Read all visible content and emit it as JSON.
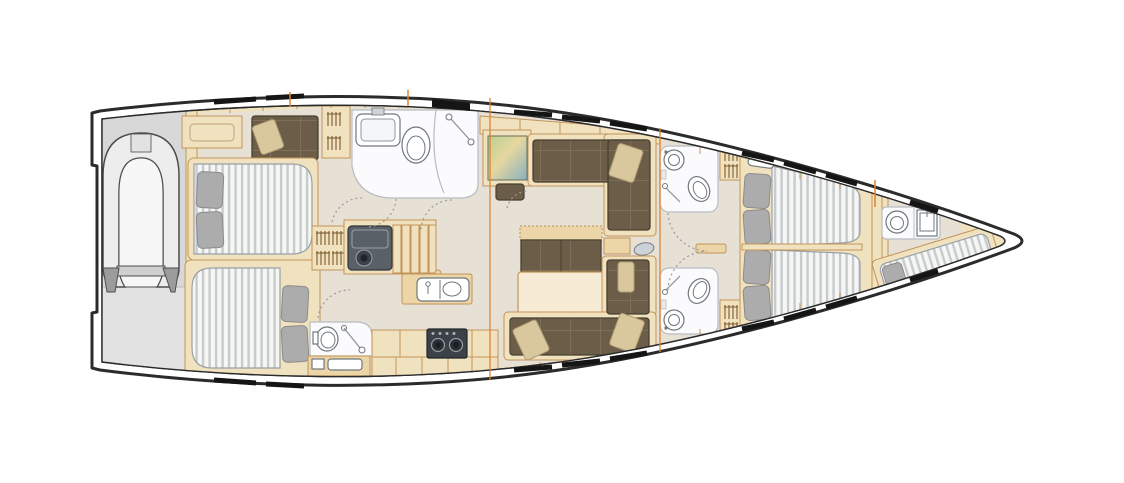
{
  "meta": {
    "label": "sailing-yacht-interior-deck-plan",
    "orientation": "bow-right",
    "visible_text": ""
  },
  "palette": {
    "hull_outline": "#2b2b2b",
    "deck_tan": "#f1e2bf",
    "deck_tan_dark": "#ecd5a6",
    "wood_line": "#c2945a",
    "floor_gray": "#e7e1d5",
    "garage_gray": "#d8d8d8",
    "garage_gray_light": "#e2e2e2",
    "white_room": "#fbfbfd",
    "room_line": "#b7bcc2",
    "fixture_line": "#6f777e",
    "mattress_white": "#f6f6f3",
    "mattress_stripe": "#c6cbd0",
    "mattress_line": "#9aa0a6",
    "pillow_gray": "#acacac",
    "pillow_gray_line": "#8b8b8b",
    "sofa_brown": "#6b5d48",
    "sofa_grid": "#7d6f58",
    "sofa_line": "#46402f",
    "pillow_tan": "#d9c79d",
    "pillow_tan_line": "#b19c72",
    "hatch_black": "#151515",
    "bulkhead_orange": "#e0812f",
    "door_dash": "#9a9a9a",
    "dinghy_gray": "#ededed",
    "dinghy_dark": "#9c9c9c",
    "dinghy_line": "#4d4d4d",
    "steel_gray": "#596067",
    "stove_dark": "#3b4147",
    "tv_green": "#b8cf92",
    "tv_sand": "#e6d79f",
    "tv_blue": "#88b0c0"
  },
  "rooms": [
    {
      "id": "dinghy-garage",
      "name": "stern dinghy garage with inflatable tender"
    },
    {
      "id": "aft-cabin-port",
      "name": "aft port cabin: double berth, sofa, hanging locker"
    },
    {
      "id": "aft-cabin-starboard",
      "name": "aft starboard cabin: double berth with en-suite head"
    },
    {
      "id": "head-aft-port",
      "name": "port head with sink, toilet and shower"
    },
    {
      "id": "head-aft-starboard",
      "name": "starboard head with toilet and shower"
    },
    {
      "id": "companionway",
      "name": "companionway steps and engine box"
    },
    {
      "id": "galley",
      "name": "galley: island sink unit and counter with stove"
    },
    {
      "id": "salon",
      "name": "salon: TV console, L-settees, table with bench"
    },
    {
      "id": "head-mid-port",
      "name": "mid port head with round sink, toilet, shower"
    },
    {
      "id": "head-mid-starboard",
      "name": "mid starboard head with round sink, toilet, shower"
    },
    {
      "id": "forward-cabin-port",
      "name": "forward port berth with two pillows"
    },
    {
      "id": "forward-cabin-starboard",
      "name": "forward starboard berth with two pillows"
    },
    {
      "id": "bow-crew-head",
      "name": "bow crew head with toilet and sink"
    },
    {
      "id": "bow-crew-berth",
      "name": "angled bow crew berth"
    }
  ],
  "fixtures": {
    "berths": 5,
    "heads": 5,
    "sinks": 6,
    "toilets": 5,
    "stove_burners": 2,
    "dinghy": 1,
    "hull_window_dashes": "black segments along both sheer lines",
    "bulkhead_marks": "orange vertical lines at mast and forward bulkheads"
  }
}
